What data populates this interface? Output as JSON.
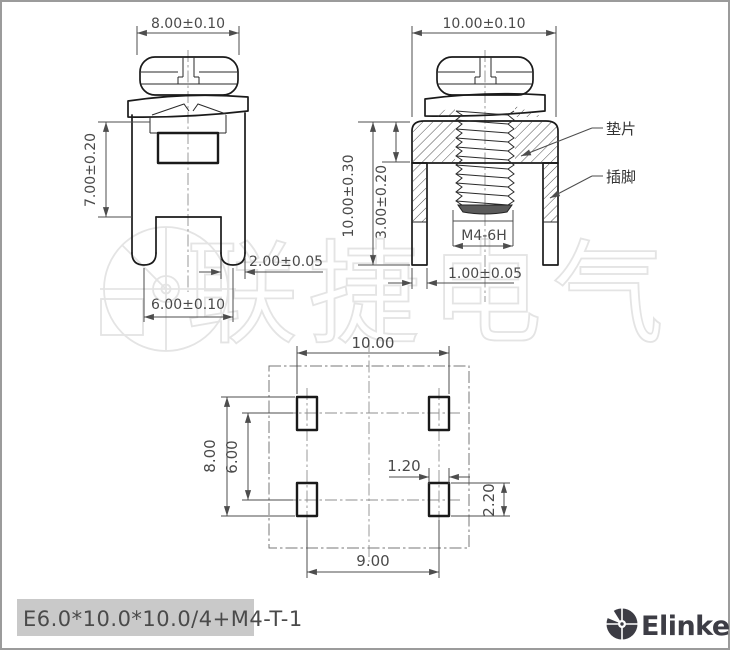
{
  "drawing": {
    "watermark_text": "联捷电气",
    "front_view": {
      "dim_head_width": "8.00±0.10",
      "dim_body_height": "7.00±0.20",
      "dim_leg_width": "2.00±0.05",
      "dim_leg_pitch": "6.00±0.10"
    },
    "section_view": {
      "dim_washer_width": "10.00±0.10",
      "dim_total_height": "10.00±0.30",
      "dim_washer_thickness": "3.00±0.20",
      "dim_pin_width": "1.00±0.05",
      "thread_spec": "M4-6H",
      "label_washer": "垫片",
      "label_pin": "插脚"
    },
    "footprint_view": {
      "dim_pad_span_x": "10.00",
      "dim_pad_span_y": "8.00",
      "dim_row_pitch": "6.00",
      "dim_pad_width": "1.20",
      "dim_pad_height": "2.20",
      "dim_col_pitch": "9.00"
    }
  },
  "title_block": {
    "part_number": "E6.0*10.0*10.0/4+M4-T-1"
  },
  "brand": {
    "name": "Elinker"
  }
}
